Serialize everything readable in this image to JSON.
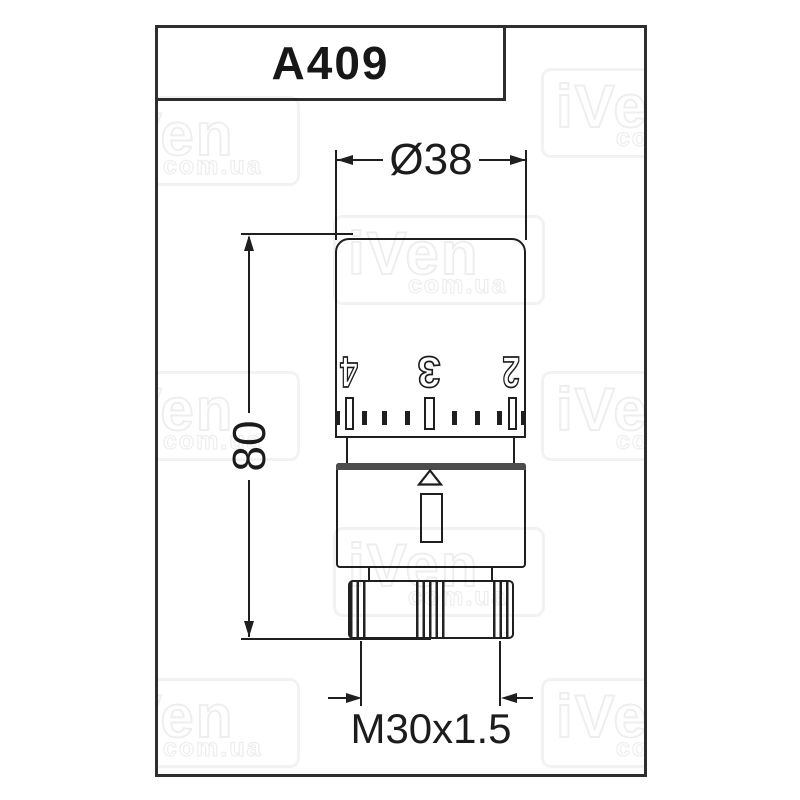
{
  "title_block": {
    "code": "A409"
  },
  "dimensions": {
    "diameter_label": "Ø38",
    "height_label": "80",
    "thread_label": "M30x1.5"
  },
  "valve_head": {
    "scale_numbers": [
      "4",
      "3",
      "2"
    ]
  },
  "watermark": {
    "brand": "iVen",
    "domain": "com.ua"
  },
  "colors": {
    "line": "#1f1f1f",
    "collar_band": "#4c4c4c",
    "watermark_gray": "#e7e7e7",
    "background": "#ffffff"
  }
}
